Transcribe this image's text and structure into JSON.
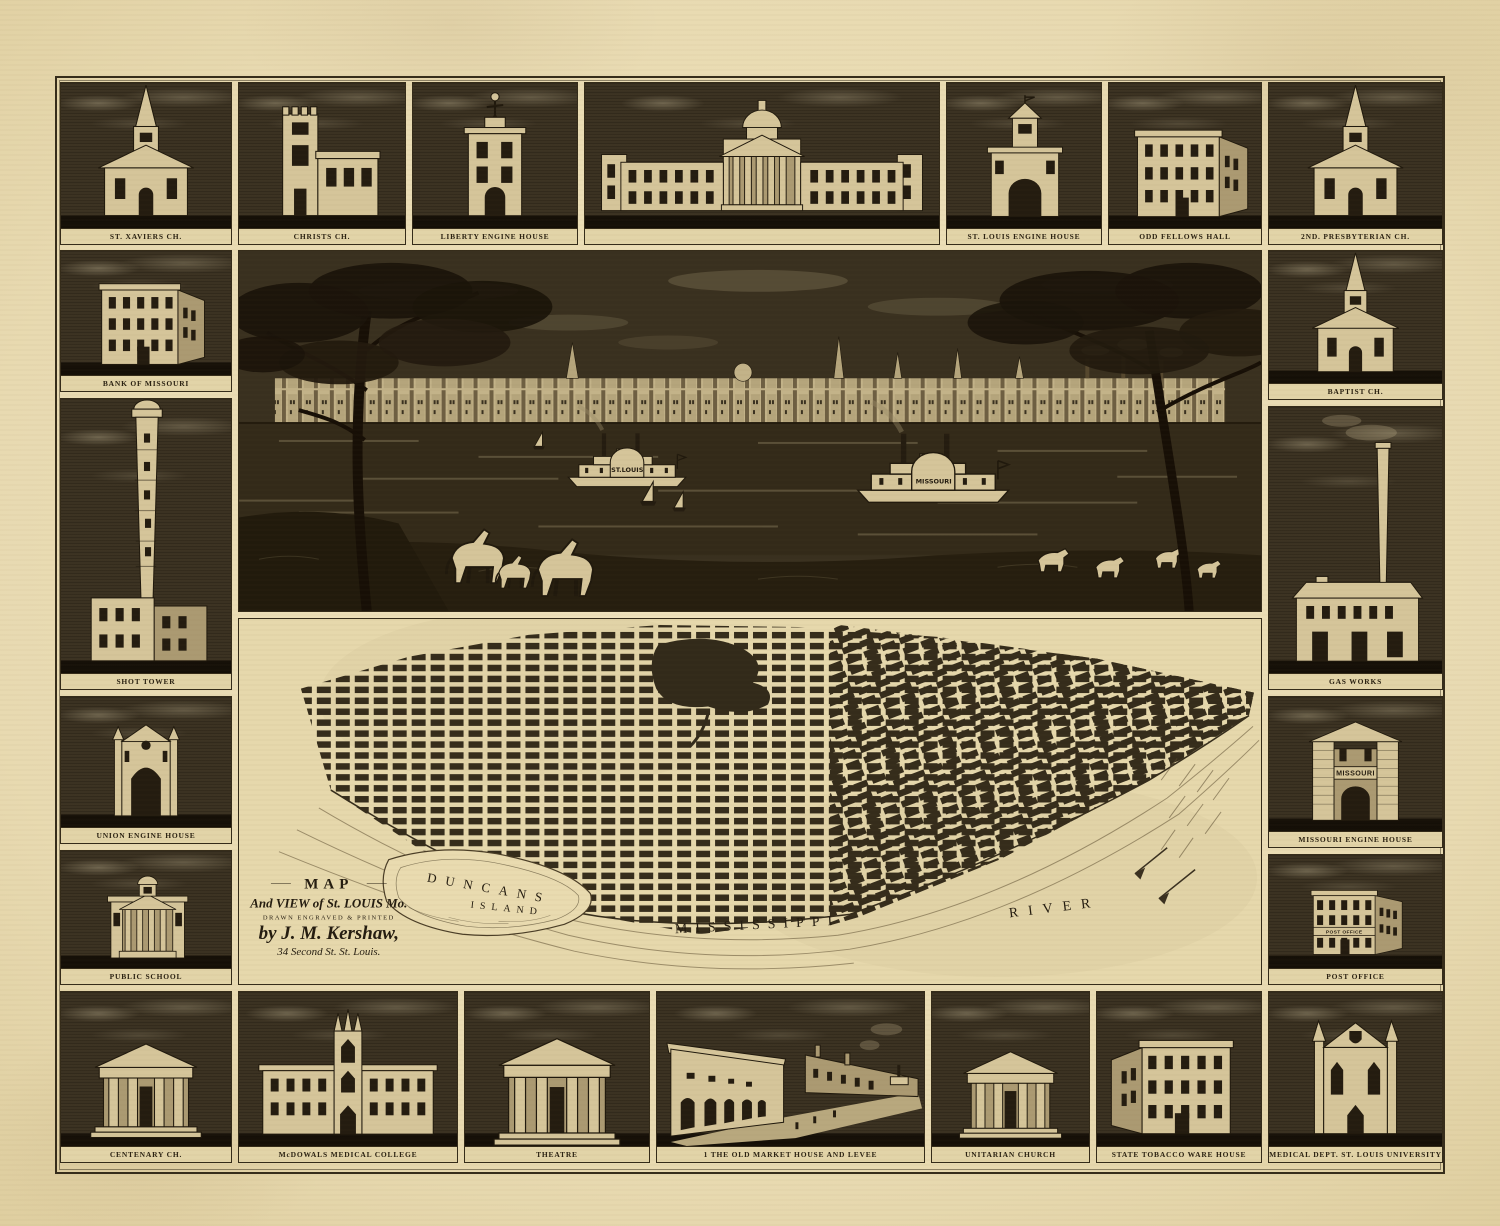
{
  "colors": {
    "paper": "#e8dab1",
    "ink": "#2b2212",
    "panel_dark": "#3b3222",
    "stone_light": "#d5c59a",
    "map_bg": "#e6d8ac"
  },
  "vignettes": {
    "top": [
      {
        "label": "ST. XAVIERS CH."
      },
      {
        "label": "CHRISTS CH."
      },
      {
        "label": "LIBERTY ENGINE HOUSE"
      },
      {
        "label": ""
      },
      {
        "label": "ST. LOUIS ENGINE HOUSE"
      },
      {
        "label": "ODD FELLOWS HALL"
      },
      {
        "label": "2ND. PRESBYTERIAN CH."
      }
    ],
    "left": [
      {
        "label": "BANK OF MISSOURI"
      },
      {
        "label": "SHOT TOWER"
      },
      {
        "label": "UNION ENGINE HOUSE"
      },
      {
        "label": "PUBLIC SCHOOL"
      }
    ],
    "right": [
      {
        "label": "BAPTIST CH."
      },
      {
        "label": "GAS WORKS"
      },
      {
        "label": "MISSOURI ENGINE HOUSE",
        "inscription": "MISSOURI"
      },
      {
        "label": "POST OFFICE",
        "inscription": "POST OFFICE"
      }
    ],
    "bottom": [
      {
        "label": "CENTENARY CH."
      },
      {
        "label": "McDOWALS MEDICAL COLLEGE"
      },
      {
        "label": "THEATRE"
      },
      {
        "label": "1 THE OLD MARKET HOUSE AND LEVEE"
      },
      {
        "label": "UNITARIAN CHURCH"
      },
      {
        "label": "STATE TOBACCO WARE HOUSE"
      },
      {
        "label": "MEDICAL DEPT. ST. LOUIS UNIVERSITY"
      }
    ]
  },
  "panorama": {
    "boats": [
      {
        "name": "ST.LOUIS"
      },
      {
        "name": "MISSOURI"
      }
    ]
  },
  "map": {
    "cartouche": {
      "line1": "MAP",
      "line2": "And VIEW of St. LOUIS Mo.",
      "line3": "DRAWN      ENGRAVED      & PRINTED",
      "line4": "by J. M. Kershaw,",
      "line5": "34 Second St. St. Louis."
    },
    "island_label_1": "DUNCANS",
    "island_label_2": "ISLAND",
    "river_label_1": "MISSISSIPPI",
    "river_label_2": "RIVER"
  }
}
